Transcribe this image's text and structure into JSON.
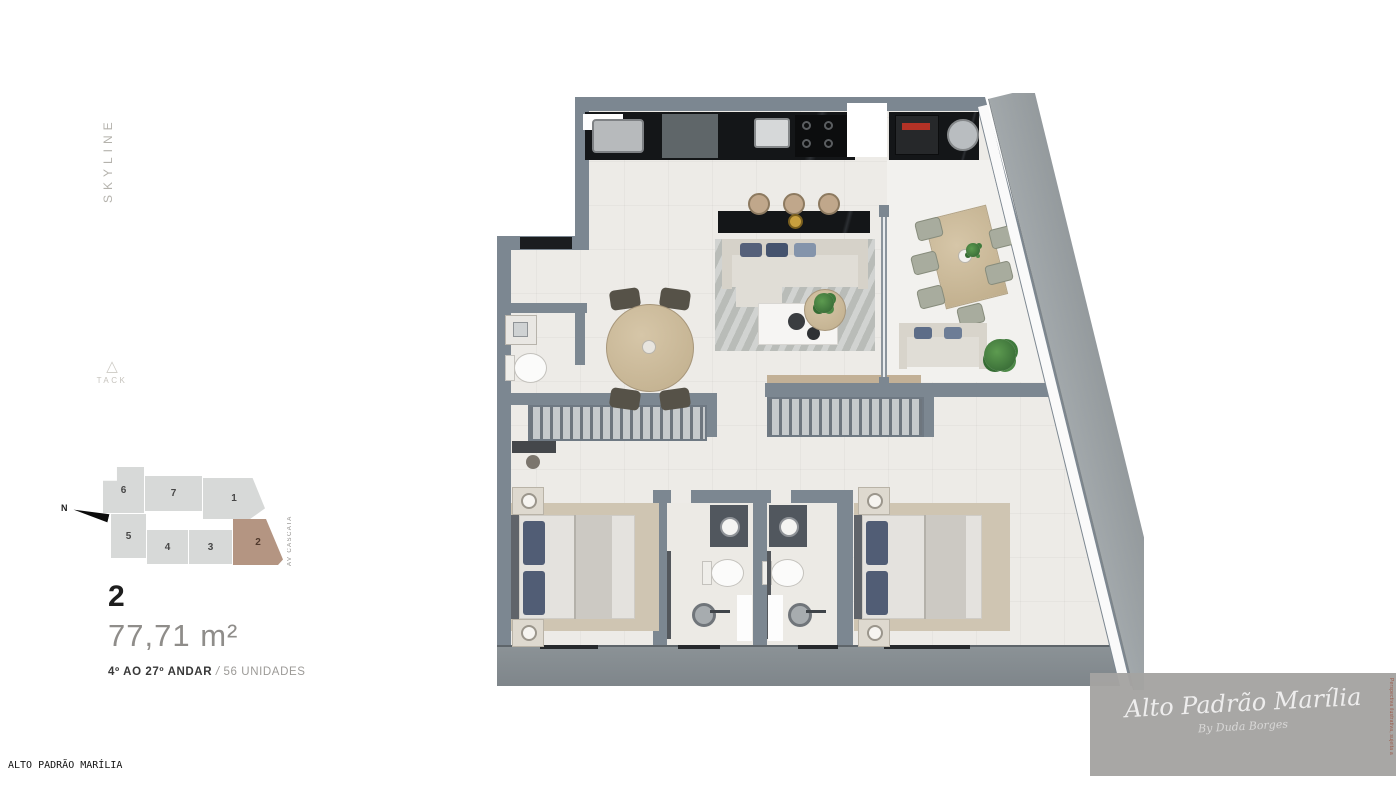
{
  "branding": {
    "vertical_logo": "SKYLINE",
    "developer_logo": "TACK",
    "developer_logo_icon": "△"
  },
  "keyplan": {
    "compass_label": "N",
    "street_label": "AV CASCATA",
    "highlighted_unit": "2",
    "units": [
      {
        "label": "6"
      },
      {
        "label": "7"
      },
      {
        "label": "1"
      },
      {
        "label": "5"
      },
      {
        "label": "4"
      },
      {
        "label": "3"
      },
      {
        "label": "2"
      }
    ]
  },
  "unit_info": {
    "number": "2",
    "area_value": "77,71",
    "area_unit": "m²",
    "floor_range": "4º AO 27º ANDAR",
    "separator": "/",
    "units_count": "56 UNIDADES"
  },
  "footer": {
    "site_name": "ALTO PADRÃO MARÍLIA"
  },
  "watermark": {
    "title": "Alto Padrão Marília",
    "signature": "By Duda Borges",
    "disclaimer": "Perspectiva ilustrativa, sujeita a alterações, até a entrega do empreendimento, de acordo com o memorial descritivo."
  },
  "palette": {
    "wall": "#7c8791",
    "floor": "#edebe7",
    "balcony_slab": "#858c91",
    "facade_concrete": "#9aa0a3",
    "counter_black": "#151719",
    "wood": "#c8b69a",
    "keyplan_unit": "#d7d9d8",
    "keyplan_highlight": "#b49582",
    "pillow_blue": "#55607a",
    "plant_green": "#3f7a3c",
    "watermark_bg": "#a4a3a1",
    "disclaimer_red": "#9c5847"
  }
}
